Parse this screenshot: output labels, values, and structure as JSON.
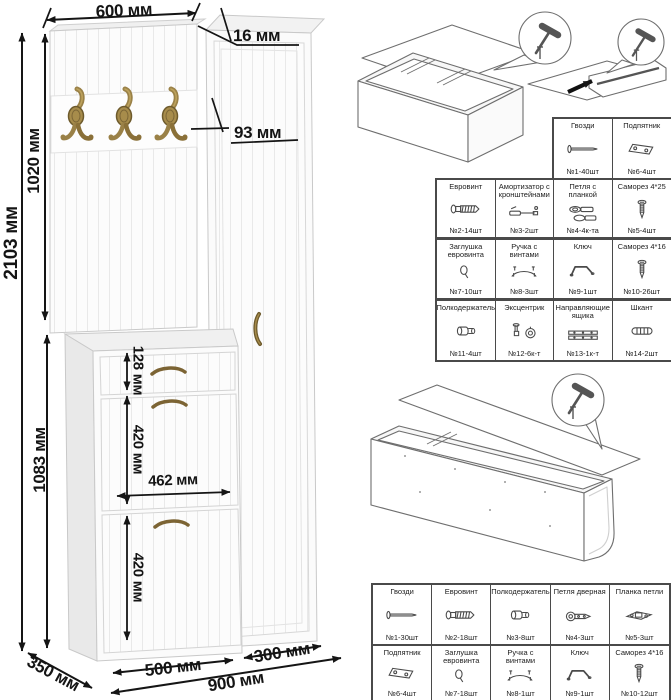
{
  "figure": {
    "kind": "furniture assembly dimension diagram"
  },
  "dimensions": {
    "top_width": "600 мм",
    "panel_thickness": "16 мм",
    "hook_row_offset": "93 мм",
    "total_height": "2103 мм",
    "upper_section_height": "1020 мм",
    "lower_section_height": "1083 мм",
    "drawer_front_height": "128 мм",
    "upper_door_height": "420 мм",
    "inner_width": "462 мм",
    "lower_door_height": "420 мм",
    "shoe_cabinet_width": "500 мм",
    "wardrobe_width": "300 мм",
    "total_width": "900 мм",
    "depth": "350 мм"
  },
  "hardware_table_upper": {
    "row1": [
      {
        "title": "Гвозди",
        "qty": "№1-40шт",
        "icon": "nail-icon"
      },
      {
        "title": "Подпятник",
        "qty": "№6-4шт",
        "icon": "furniture-glide-icon"
      }
    ],
    "row2": [
      {
        "title": "Евровинт",
        "qty": "№2-14шт",
        "icon": "confirmat-screw-icon"
      },
      {
        "title": "Амортизатор с кронштейнами",
        "qty": "№3-2шт",
        "icon": "gas-lift-icon"
      },
      {
        "title": "Петля с планкой",
        "qty": "№4-4к-та",
        "icon": "hinge-with-plate-icon"
      },
      {
        "title": "Саморез 4*25",
        "qty": "№5-4шт",
        "icon": "screw-icon"
      }
    ],
    "row3": [
      {
        "title": "Заглушка евровинта",
        "qty": "№7-10шт",
        "icon": "screw-cap-icon"
      },
      {
        "title": "Ручка с винтами",
        "qty": "№8-3шт",
        "icon": "handle-icon"
      },
      {
        "title": "Ключ",
        "qty": "№9-1шт",
        "icon": "hex-key-icon"
      },
      {
        "title": "Саморез 4*16",
        "qty": "№10-26шт",
        "icon": "screw-icon"
      }
    ],
    "row4": [
      {
        "title": "Полкодержатель",
        "qty": "№11-4шт",
        "icon": "shelf-pin-icon"
      },
      {
        "title": "Эксцентрик",
        "qty": "№12-6к-т",
        "icon": "cam-lock-icon"
      },
      {
        "title": "Направляющие ящика",
        "qty": "№13-1к-т",
        "icon": "drawer-slides-icon"
      },
      {
        "title": "Шкант",
        "qty": "№14-2шт",
        "icon": "dowel-icon"
      }
    ]
  },
  "hardware_table_lower": {
    "row1": [
      {
        "title": "Гвозди",
        "qty": "№1-30шт",
        "icon": "nail-icon"
      },
      {
        "title": "Евровинт",
        "qty": "№2-18шт",
        "icon": "confirmat-screw-icon"
      },
      {
        "title": "Полкодержатель",
        "qty": "№3-8шт",
        "icon": "shelf-pin-icon"
      },
      {
        "title": "Петля дверная",
        "qty": "№4-3шт",
        "icon": "door-hinge-icon"
      },
      {
        "title": "Планка петли",
        "qty": "№5-3шт",
        "icon": "hinge-plate-icon"
      }
    ],
    "row2": [
      {
        "title": "Подпятник",
        "qty": "№6-4шт",
        "icon": "furniture-glide-icon"
      },
      {
        "title": "Заглушка евровинта",
        "qty": "№7-18шт",
        "icon": "screw-cap-icon"
      },
      {
        "title": "Ручка с винтами",
        "qty": "№8-1шт",
        "icon": "handle-icon"
      },
      {
        "title": "Ключ",
        "qty": "№9-1шт",
        "icon": "hex-key-icon"
      },
      {
        "title": "Саморез 4*16",
        "qty": "№10-12шт",
        "icon": "screw-icon"
      }
    ]
  },
  "icons": {
    "nail-icon": "sym-nail",
    "furniture-glide-icon": "sym-glide",
    "confirmat-screw-icon": "sym-confirmat",
    "gas-lift-icon": "sym-piston",
    "hinge-with-plate-icon": "sym-hinge",
    "screw-icon": "sym-screw",
    "screw-cap-icon": "sym-cap",
    "handle-icon": "sym-handle",
    "hex-key-icon": "sym-key",
    "shelf-pin-icon": "sym-shelfpin",
    "cam-lock-icon": "sym-cam",
    "drawer-slides-icon": "sym-slides",
    "dowel-icon": "sym-dowel",
    "door-hinge-icon": "sym-doorhinge",
    "hinge-plate-icon": "sym-hingeplate",
    "hammer-icon": "hammer"
  },
  "colors": {
    "dimension_line": "#151515",
    "furniture_stroke": "#c9c9c9",
    "brass": "#9a8147",
    "table_border": "#4a4a4a",
    "sketch_stroke": "#6e6e6e"
  }
}
